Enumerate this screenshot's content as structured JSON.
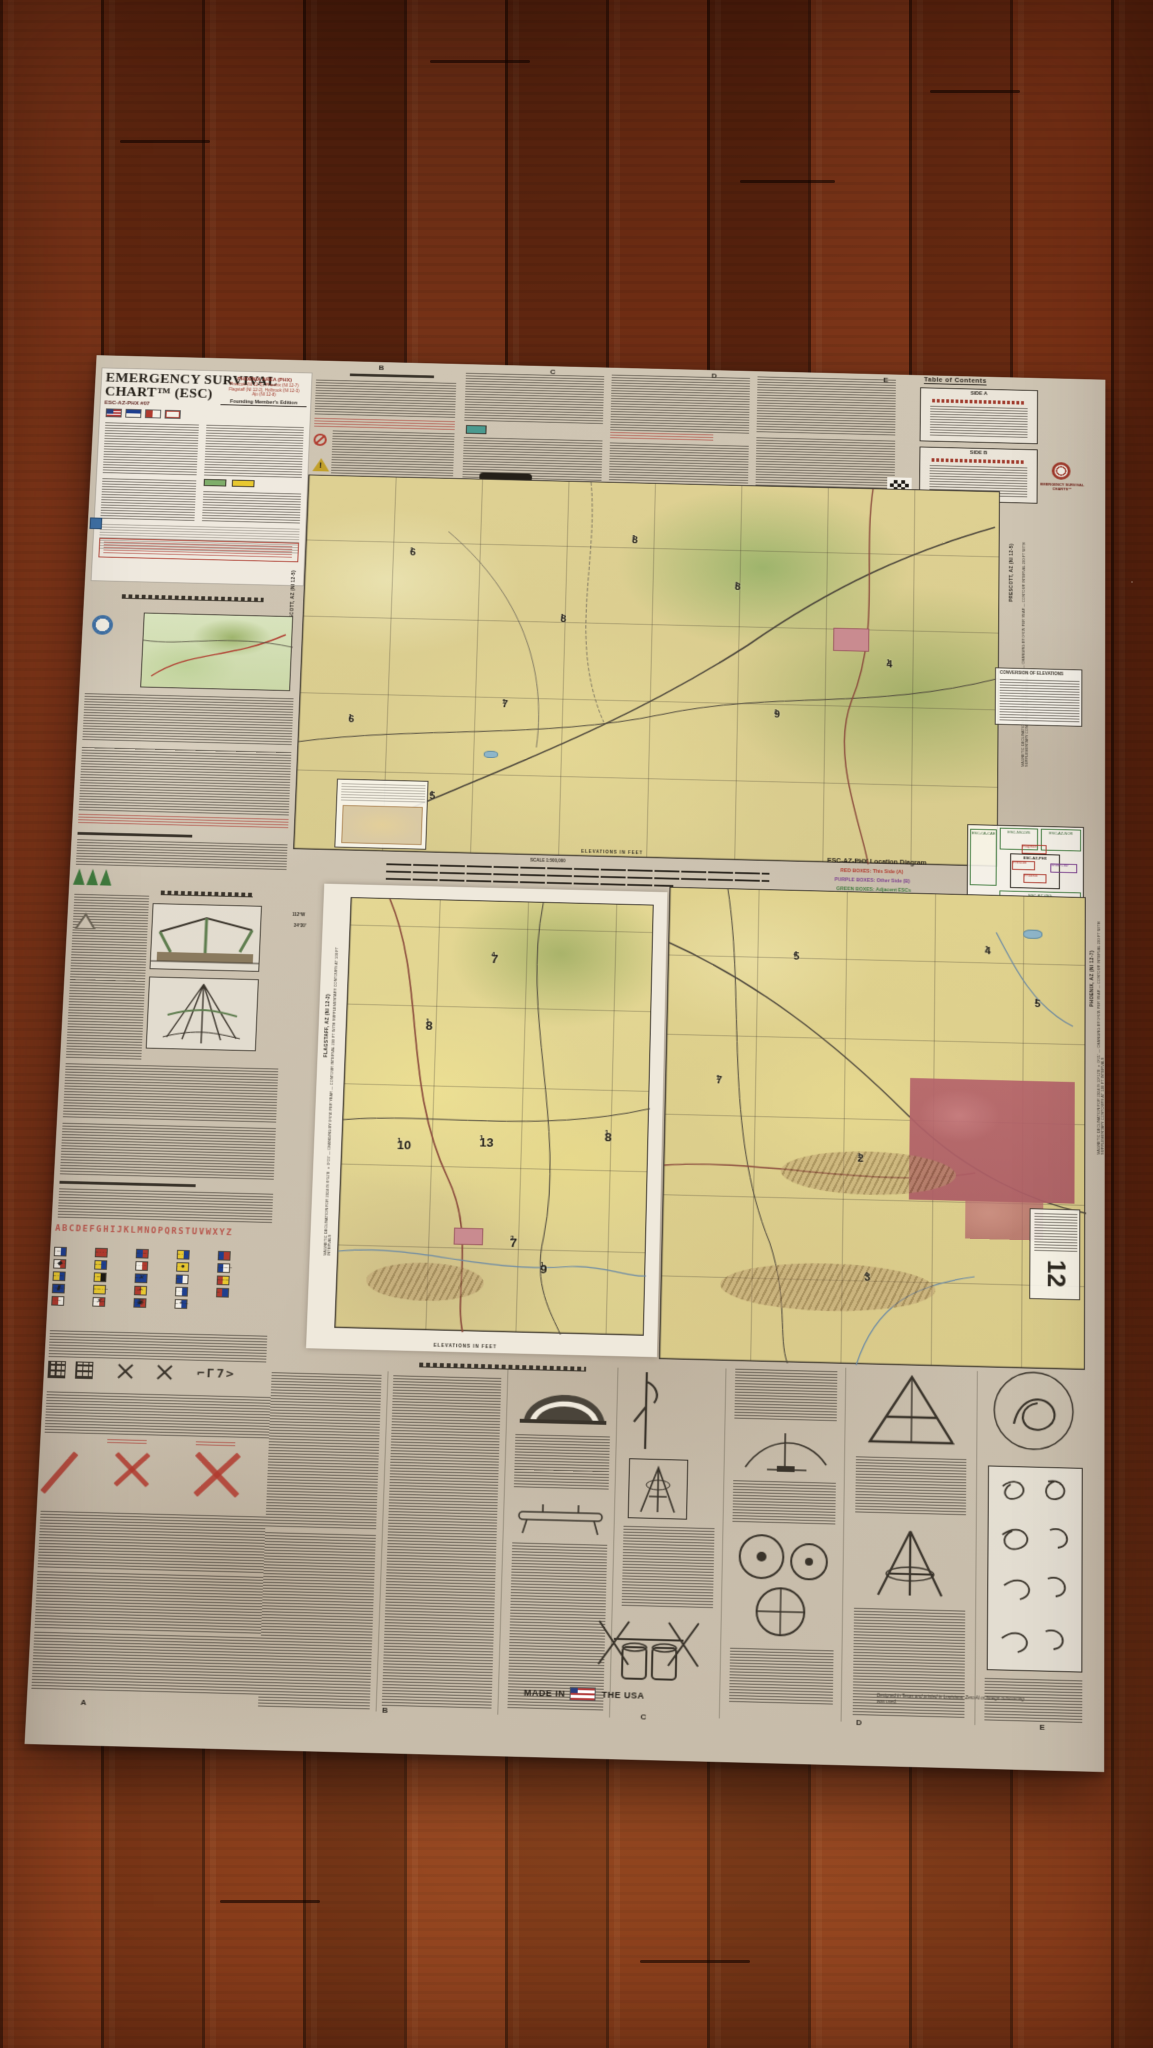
{
  "title_block": {
    "title_line1": "EMERGENCY SURVIVAL",
    "title_line2": "CHART™ (ESC)",
    "chart_id": "ESC-AZ-PHX #07",
    "area_title": "PHOENIX AREA (PHX)",
    "area_lines": [
      "Prescott (NI 12-5), Phoenix (NI 12-7)",
      "Flagstaff (NI 12-2), Holbrook (NI 12-3)",
      "Ajo (NI 12-8)"
    ],
    "edition_label": "Founding Member's Edition"
  },
  "branding": {
    "logo_text": "EMERGENCY SURVIVAL CHARTS™"
  },
  "toc": {
    "title": "Table of Contents",
    "side_a_label": "SIDE A",
    "side_b_label": "SIDE B"
  },
  "location_diagram": {
    "title": "ESC-AZ-PHX Location Diagram",
    "legend": [
      {
        "text": "RED BOXES: This Side (A)",
        "color": "#b03a2e"
      },
      {
        "text": "PURPLE BOXES: Other Side (B)",
        "color": "#7b3f8f"
      },
      {
        "text": "GREEN BOXES: Adjacent ESCs",
        "color": "#3f7a3d"
      }
    ],
    "boxes": {
      "left": "ESC-CA-CAE",
      "top_mid": "ESC-NV-LVS",
      "top_right": "ESC-AZ-NOR",
      "center": "ESC-AZ-PHX",
      "bottom": "ESC-AZ-YBG"
    },
    "red_boxes": {
      "flagstaff": "Flagstaff",
      "prescott": "Prescott",
      "phoenix": "Phoenix"
    },
    "purple_box": "Show Low"
  },
  "margins": {
    "prescott_label": "PRESCOTT, AZ  (NI 12-5)",
    "prescott_note": "MAGNETIC DECLINATION FOR 2024 IS 10°17′E ± 0°21′ — CHANGING BY 0°6′W PER YEAR — CONTOUR INTERVAL 200 FT WITH SUPPLEMENTARY CONTOURS AT 100 FT INTERVALS",
    "flagstaff_label": "FLAGSTAFF, AZ  (NI 12-2)",
    "flagstaff_note": "MAGNETIC DECLINATION FOR 2024 IS 8°52′E ± 0°23′ — CHANGING BY 0°6′W PER YEAR — CONTOUR INTERVAL 200 FT WITH SUPPLEMENTARY CONTOURS AT 100 FT INTERVALS",
    "phoenix_label": "PHOENIX, AZ  (NI 12-7)",
    "phoenix_note": "MAGNETIC DECLINATION FOR 2024 IS 10°12′E ± 0°21′ — CHANGING BY 0°6′W PER YEAR — CONTOUR INTERVAL 200 FT WITH SUPPLEMENTARY CONTOURS AT 100 FT INTERVALS",
    "conversion_title": "CONVERSION OF ELEVATIONS",
    "elevations_label": "ELEVATIONS IN FEET",
    "coord_west": "112°W",
    "coord_lat": "34°30′",
    "note_box_number": "12"
  },
  "scale": {
    "label": "SCALE 1:500,000"
  },
  "grid_refs": {
    "top": [
      {
        "v": "B",
        "x": 28
      },
      {
        "v": "C",
        "x": 45
      },
      {
        "v": "D",
        "x": 61
      },
      {
        "v": "E",
        "x": 78
      }
    ],
    "bottom": [
      {
        "v": "A",
        "x": 5
      },
      {
        "v": "B",
        "x": 33
      },
      {
        "v": "C",
        "x": 57
      },
      {
        "v": "D",
        "x": 77
      },
      {
        "v": "E",
        "x": 94
      }
    ]
  },
  "maps": {
    "upper_mefs": [
      {
        "v": "6",
        "s": "1",
        "x": 15,
        "y": 19
      },
      {
        "v": "8",
        "s": "1",
        "x": 47,
        "y": 14
      },
      {
        "v": "8",
        "s": "1",
        "x": 37,
        "y": 36
      },
      {
        "v": "6",
        "s": "1",
        "x": 7,
        "y": 64
      },
      {
        "v": "7",
        "s": "1",
        "x": 29,
        "y": 59
      },
      {
        "v": "5",
        "s": "4",
        "x": 19,
        "y": 84
      },
      {
        "v": "8",
        "s": "1",
        "x": 62,
        "y": 26
      },
      {
        "v": "9",
        "s": "1",
        "x": 68,
        "y": 60
      },
      {
        "v": "4",
        "s": "1",
        "x": 84,
        "y": 46
      }
    ],
    "inset_mefs": [
      {
        "v": "8",
        "s": "1",
        "x": 26,
        "y": 28
      },
      {
        "v": "7",
        "s": "4",
        "x": 47,
        "y": 12
      },
      {
        "v": "10",
        "s": "1",
        "x": 18,
        "y": 56
      },
      {
        "v": "13",
        "s": "1",
        "x": 45,
        "y": 55
      },
      {
        "v": "8",
        "s": "1",
        "x": 86,
        "y": 53
      },
      {
        "v": "7",
        "s": "2",
        "x": 56,
        "y": 78
      },
      {
        "v": "9",
        "s": "1",
        "x": 66,
        "y": 84
      }
    ],
    "phoenix_mefs": [
      {
        "v": "5",
        "s": "4",
        "x": 30,
        "y": 13
      },
      {
        "v": "4",
        "s": "1",
        "x": 76,
        "y": 11
      },
      {
        "v": "2",
        "s": "1",
        "x": 46,
        "y": 56
      },
      {
        "v": "3",
        "s": "4",
        "x": 48,
        "y": 81
      },
      {
        "v": "5",
        "s": "1",
        "x": 88,
        "y": 22
      },
      {
        "v": "7",
        "s": "1",
        "x": 12,
        "y": 40
      }
    ]
  },
  "signals": {
    "alphabet": "ABCDEFGHIJKLMNOPQRSTUVWXYZ",
    "ground_glyphs": "⌐Γ7>",
    "flags": [
      {
        "c1": "#f3efe6",
        "c2": "#1e3f8f",
        "m": "·–"
      },
      {
        "c1": "#b03a2e",
        "c2": "#b03a2e",
        "m": "–···"
      },
      {
        "c1": "#1e3f8f",
        "c2": "#b03a2e",
        "m": "–·–·"
      },
      {
        "c1": "#e8c830",
        "c2": "#1e3f8f",
        "m": "–··"
      },
      {
        "c1": "#1e3f8f",
        "c2": "#b03a2e",
        "m": "·"
      },
      {
        "c1": "#f3efe6",
        "c2": "#b03a2e",
        "m": "··–·",
        "g": "◆"
      },
      {
        "c1": "#e8c830",
        "c2": "#1e3f8f",
        "m": "––·"
      },
      {
        "c1": "#f3efe6",
        "c2": "#b03a2e",
        "m": "····"
      },
      {
        "c1": "#e8c830",
        "c2": "#e8c830",
        "m": "··",
        "g": "●"
      },
      {
        "c1": "#1e3f8f",
        "c2": "#f3efe6",
        "m": "·–––"
      },
      {
        "c1": "#e8c830",
        "c2": "#1e3f8f",
        "m": "–·–"
      },
      {
        "c1": "#e8c830",
        "c2": "#1b1813",
        "m": "·–··"
      },
      {
        "c1": "#1e3f8f",
        "c2": "#1e3f8f",
        "m": "––",
        "g": "✕"
      },
      {
        "c1": "#1e3f8f",
        "c2": "#f3efe6",
        "m": "–·"
      },
      {
        "c1": "#b03a2e",
        "c2": "#e8c830",
        "m": "–––"
      },
      {
        "c1": "#1e3f8f",
        "c2": "#1e3f8f",
        "m": "·––·",
        "g": "▮"
      },
      {
        "c1": "#e8c830",
        "c2": "#e8c830",
        "m": "––·–"
      },
      {
        "c1": "#b03a2e",
        "c2": "#e8c830",
        "m": "·–·",
        "g": "+"
      },
      {
        "c1": "#f3efe6",
        "c2": "#1e3f8f",
        "m": "···"
      },
      {
        "c1": "#b03a2e",
        "c2": "#1e3f8f",
        "m": "–"
      },
      {
        "c1": "#b03a2e",
        "c2": "#f3efe6",
        "m": "··–"
      },
      {
        "c1": "#f3efe6",
        "c2": "#b03a2e",
        "m": "···–",
        "g": "✕"
      },
      {
        "c1": "#1e3f8f",
        "c2": "#b03a2e",
        "m": "·––",
        "g": "▣"
      },
      {
        "c1": "#f3efe6",
        "c2": "#1e3f8f",
        "m": "–··–",
        "g": "+"
      }
    ]
  },
  "footer": {
    "made_in": "MADE IN",
    "the_usa": "THE USA",
    "made_note": "Designed in Texas and printed in Louisiana. Zero AI or foreign outsourcing was used."
  }
}
